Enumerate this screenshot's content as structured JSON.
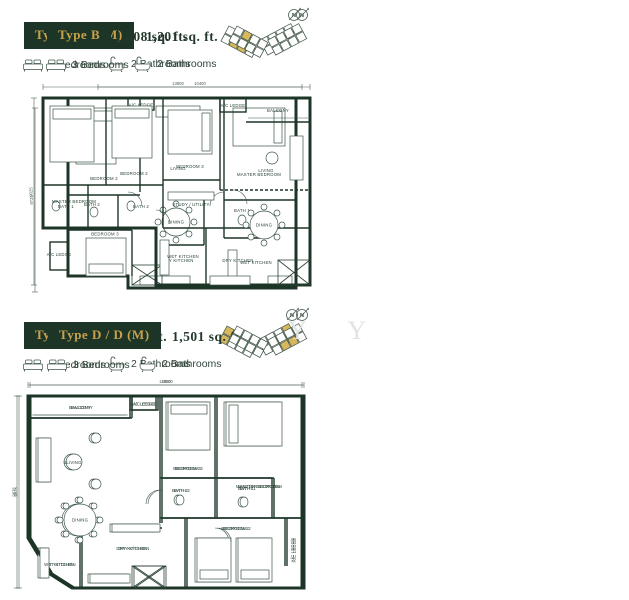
{
  "colors": {
    "green": "#1d3527",
    "gold": "#c8a24b",
    "keyplan_gold": "#d9b85c",
    "line": "#3c5548"
  },
  "north_label": "N",
  "watermark": "Y Y",
  "units": [
    {
      "id": "A",
      "type_label": "Type A / A (M)",
      "area": "1,201 sq. ft.",
      "bedrooms": "3 Bedrooms",
      "bathrooms": "2 Bathrooms",
      "dims": {
        "top": "10400",
        "side": "9725"
      },
      "rooms": {
        "ac_ledge_top": "A/C LEDGE",
        "bedroom2": "BEDROOM 2",
        "living": "LIVING",
        "master_bedroom": "MASTER BEDROOM",
        "dining": "DINING",
        "bath2": "BATH 2",
        "bath1": "BATH 1",
        "bedroom3": "BEDROOM 3",
        "ac_ledge_side": "A/C LEDGE",
        "dry_kitchen": "DRY KITCHEN",
        "wet_kitchen": "WET KITCHEN"
      }
    },
    {
      "id": "B",
      "type_label": "Type B",
      "area": "1,408 sq. ft.",
      "bedrooms": "3 Bedrooms",
      "bathrooms": "2 Bathrooms",
      "dims": {
        "top": "13800",
        "side": "9025"
      },
      "rooms": {
        "master_bedroom": "MASTER BEDROOM",
        "bedroom2": "BEDROOM 2",
        "bedroom3": "BEDROOM 3",
        "ac_ledge": "A/C LEDGE",
        "balcony": "BALCONY",
        "living": "LIVING",
        "bath1": "BATH 1",
        "bath2": "BATH 2",
        "study": "STUDY / UTILITY",
        "dining": "DINING",
        "wet_kitchen": "WET KITCHEN",
        "dry_kitchen": "DRY KITCHEN"
      }
    },
    {
      "id": "C",
      "type_label": "Type C",
      "area": "1,485 sq. ft.",
      "bedrooms": "3 Bedrooms",
      "bathrooms": "2 Bathrooms",
      "dims": {
        "top": "13000",
        "side": "9875"
      },
      "rooms": {
        "balcony": "BALCONY",
        "ac_ledge": "A/C LEDGE",
        "living": "LIVING",
        "dining": "DINING",
        "bedroom3": "BEDROOM 3",
        "master_bedroom": "MASTER BEDROOM",
        "bath2": "BATH 2",
        "bath1": "BATH 1",
        "bedroom2": "BEDROOM 2",
        "ac_ledge_side": "A/C LEDGE",
        "dry_kitchen": "DRY KITCHEN",
        "wet_kitchen": "WET KITCHEN"
      }
    },
    {
      "id": "D",
      "type_label": "Type D / D (M)",
      "area": "1,501 sq. ft.",
      "bedrooms": "3 Bedrooms",
      "bathrooms": "2 Bathrooms",
      "dims": {
        "top": "13000",
        "side": "9875"
      },
      "rooms": {
        "balcony": "BALCONY",
        "ac_ledge": "A/C LEDGE",
        "living": "LIVING",
        "dining": "DINING",
        "bedroom3": "BEDROOM 3",
        "master_bedroom": "MASTER BEDROOM",
        "bath2": "BATH 2",
        "bath1": "BATH 1",
        "bedroom2": "BEDROOM 2",
        "ac_ledge_side": "A/C LEDGE",
        "dry_kitchen": "DRY KITCHEN",
        "wet_kitchen": "WET KITCHEN"
      }
    }
  ]
}
